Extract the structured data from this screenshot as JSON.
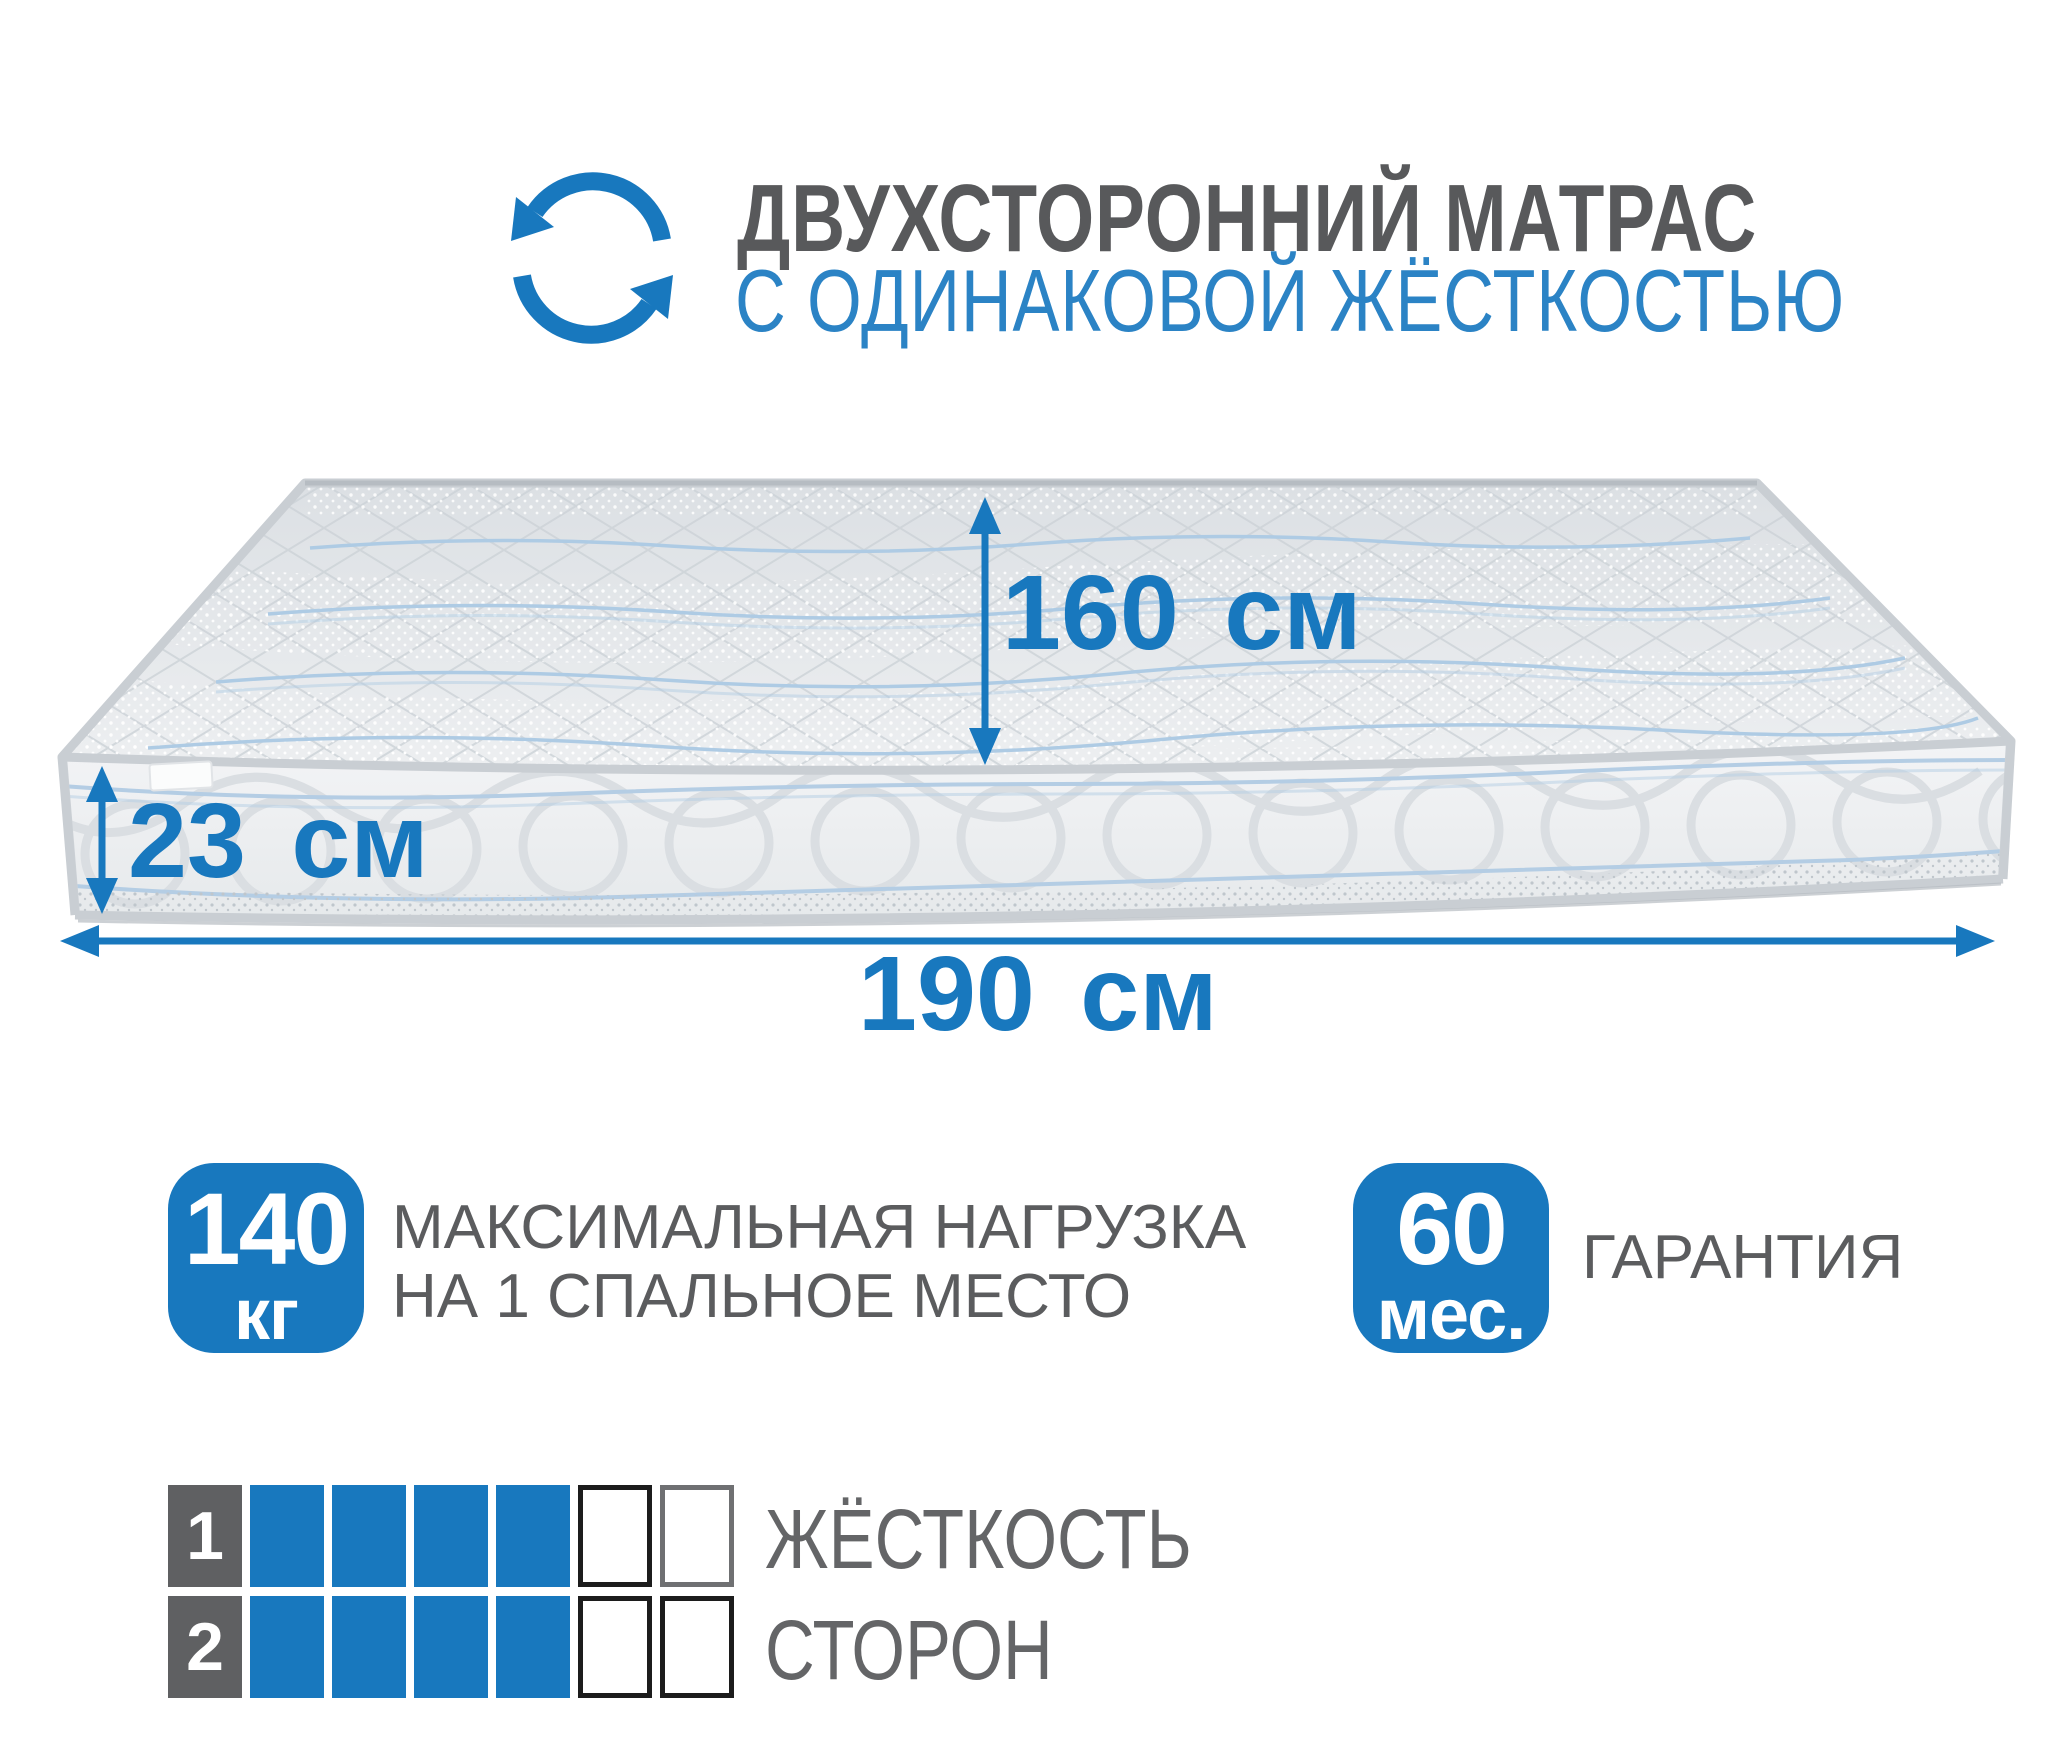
{
  "header": {
    "title_line1": "ДВУХСТОРОННИЙ МАТРАС",
    "title_line2": "С ОДИНАКОВОЙ ЖЁСТКОСТЬЮ"
  },
  "icon": "rotate-two-arrows-icon",
  "dimensions": {
    "bed_width": "160 см",
    "height": "23 см",
    "length": "190 см"
  },
  "badges": {
    "max_load": {
      "value": "140",
      "unit": "кг",
      "label_line1": "МАКСИМАЛЬНАЯ НАГРУЗКА",
      "label_line2": "НА 1 СПАЛЬНОЕ МЕСТО"
    },
    "warranty": {
      "value": "60",
      "unit": "мес.",
      "label": "ГАРАНТИЯ"
    }
  },
  "hardness": {
    "label_line1": "ЖЁСТКОСТЬ",
    "label_line2": "СТОРОН",
    "total_levels": 6,
    "rows": [
      {
        "num": "1",
        "filled": 4,
        "empty_borders": [
          "#1c1c1c",
          "#6f7072"
        ]
      },
      {
        "num": "2",
        "filled": 4,
        "empty_borders": [
          "#1c1c1c",
          "#1c1c1c"
        ]
      }
    ]
  },
  "colors": {
    "accent": "#1878be",
    "title_gray": "#58595b",
    "title_blue": "#2b83c5",
    "label_gray": "#5b5c5e",
    "cell_gray": "#5f6062"
  }
}
